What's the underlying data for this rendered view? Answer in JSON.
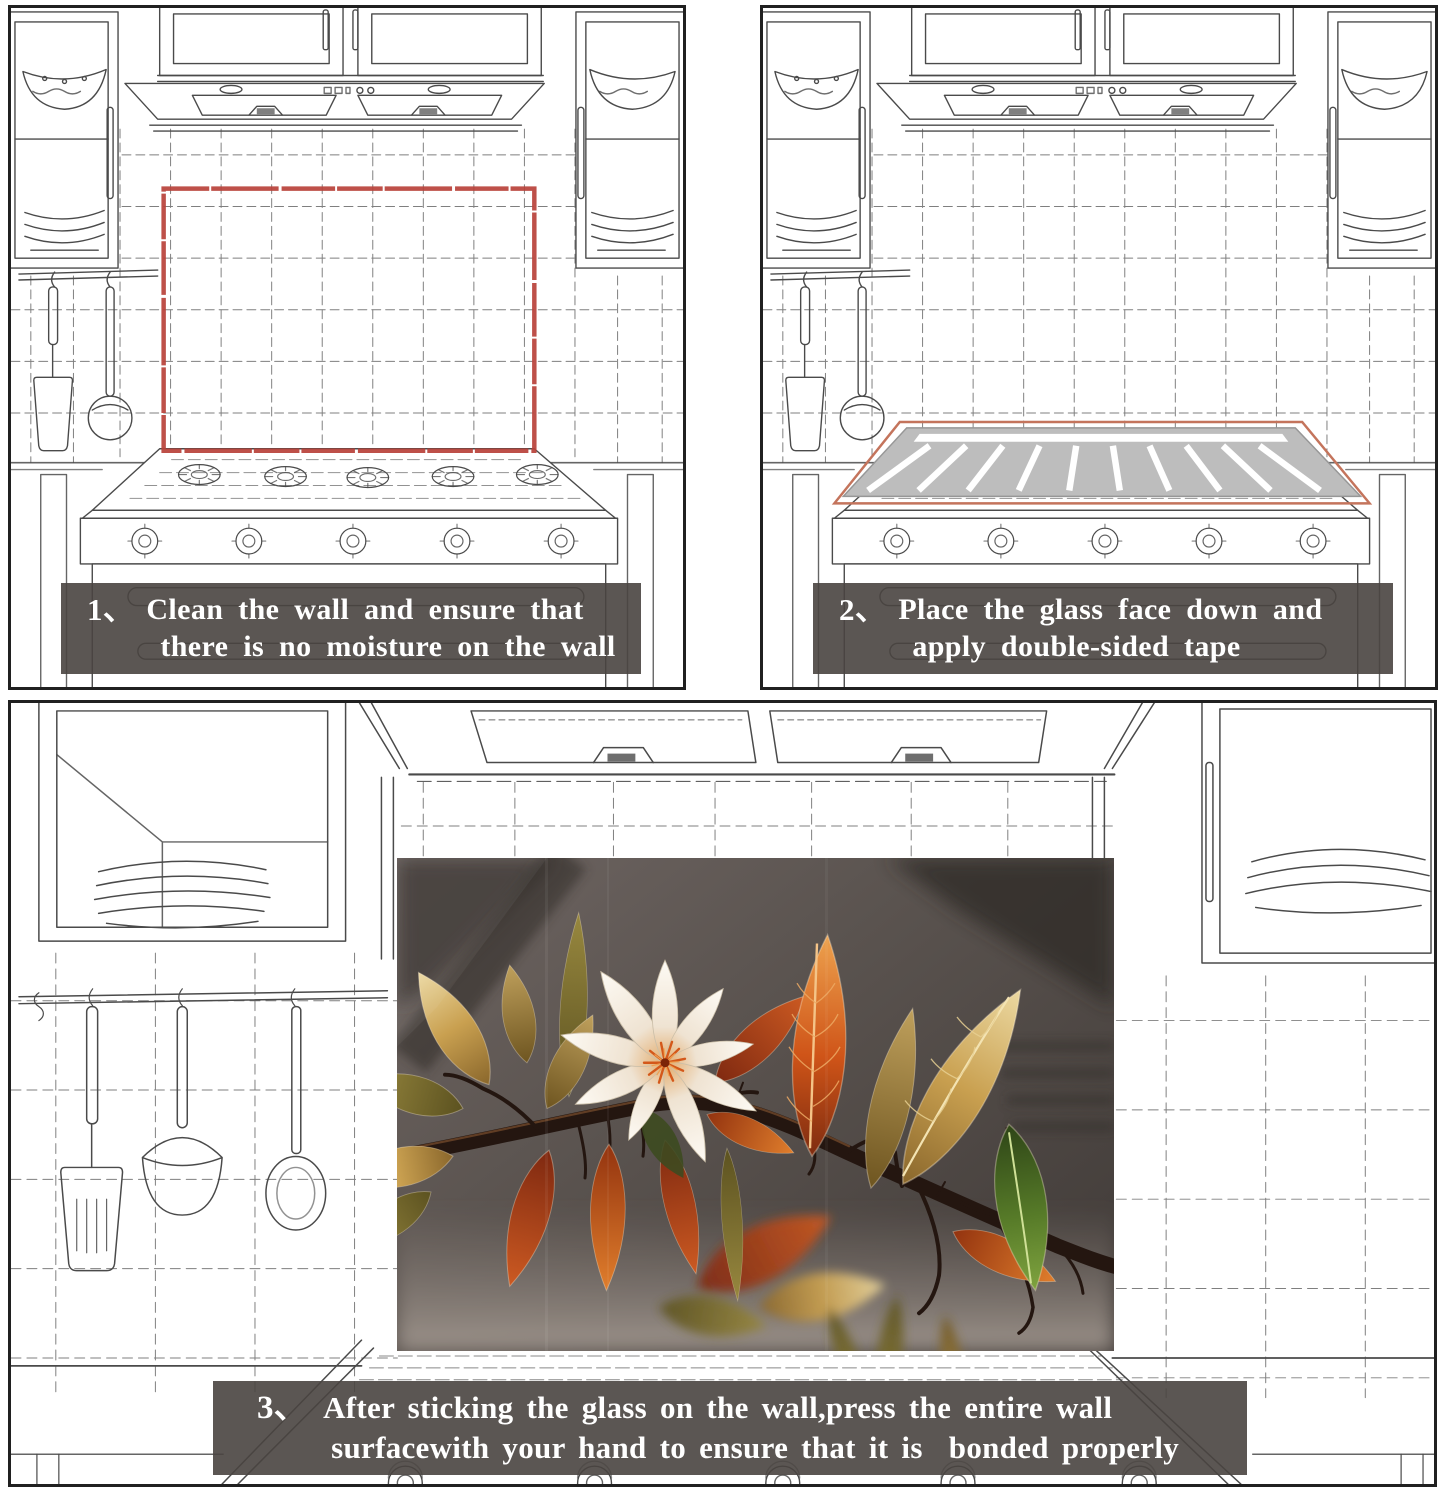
{
  "steps": [
    {
      "number": "1、",
      "line1": "Clean the wall and ensure that",
      "line2": "there is no moisture on the wall"
    },
    {
      "number": "2、",
      "line1": "Place the glass face down and",
      "line2": "apply double-sided tape"
    },
    {
      "number": "3、",
      "line1": "After sticking the glass on the wall,press the entire wall",
      "line2": "surfacewith your hand to ensure that it is  bonded properly"
    }
  ],
  "colors": {
    "caption_band": "rgba(73,68,64,0.9)",
    "caption_text": "#ffffff",
    "marked_area_outline": "#b8413a",
    "tape_edge_outline": "#c4745c",
    "glass_back": "#bdbdbd",
    "tape_stripe": "#ffffff",
    "sketch_line": "#4a4a4a",
    "panel_border": "#202020"
  },
  "artwork": {
    "name": "autumn-branch-magnolia-glass-print"
  }
}
